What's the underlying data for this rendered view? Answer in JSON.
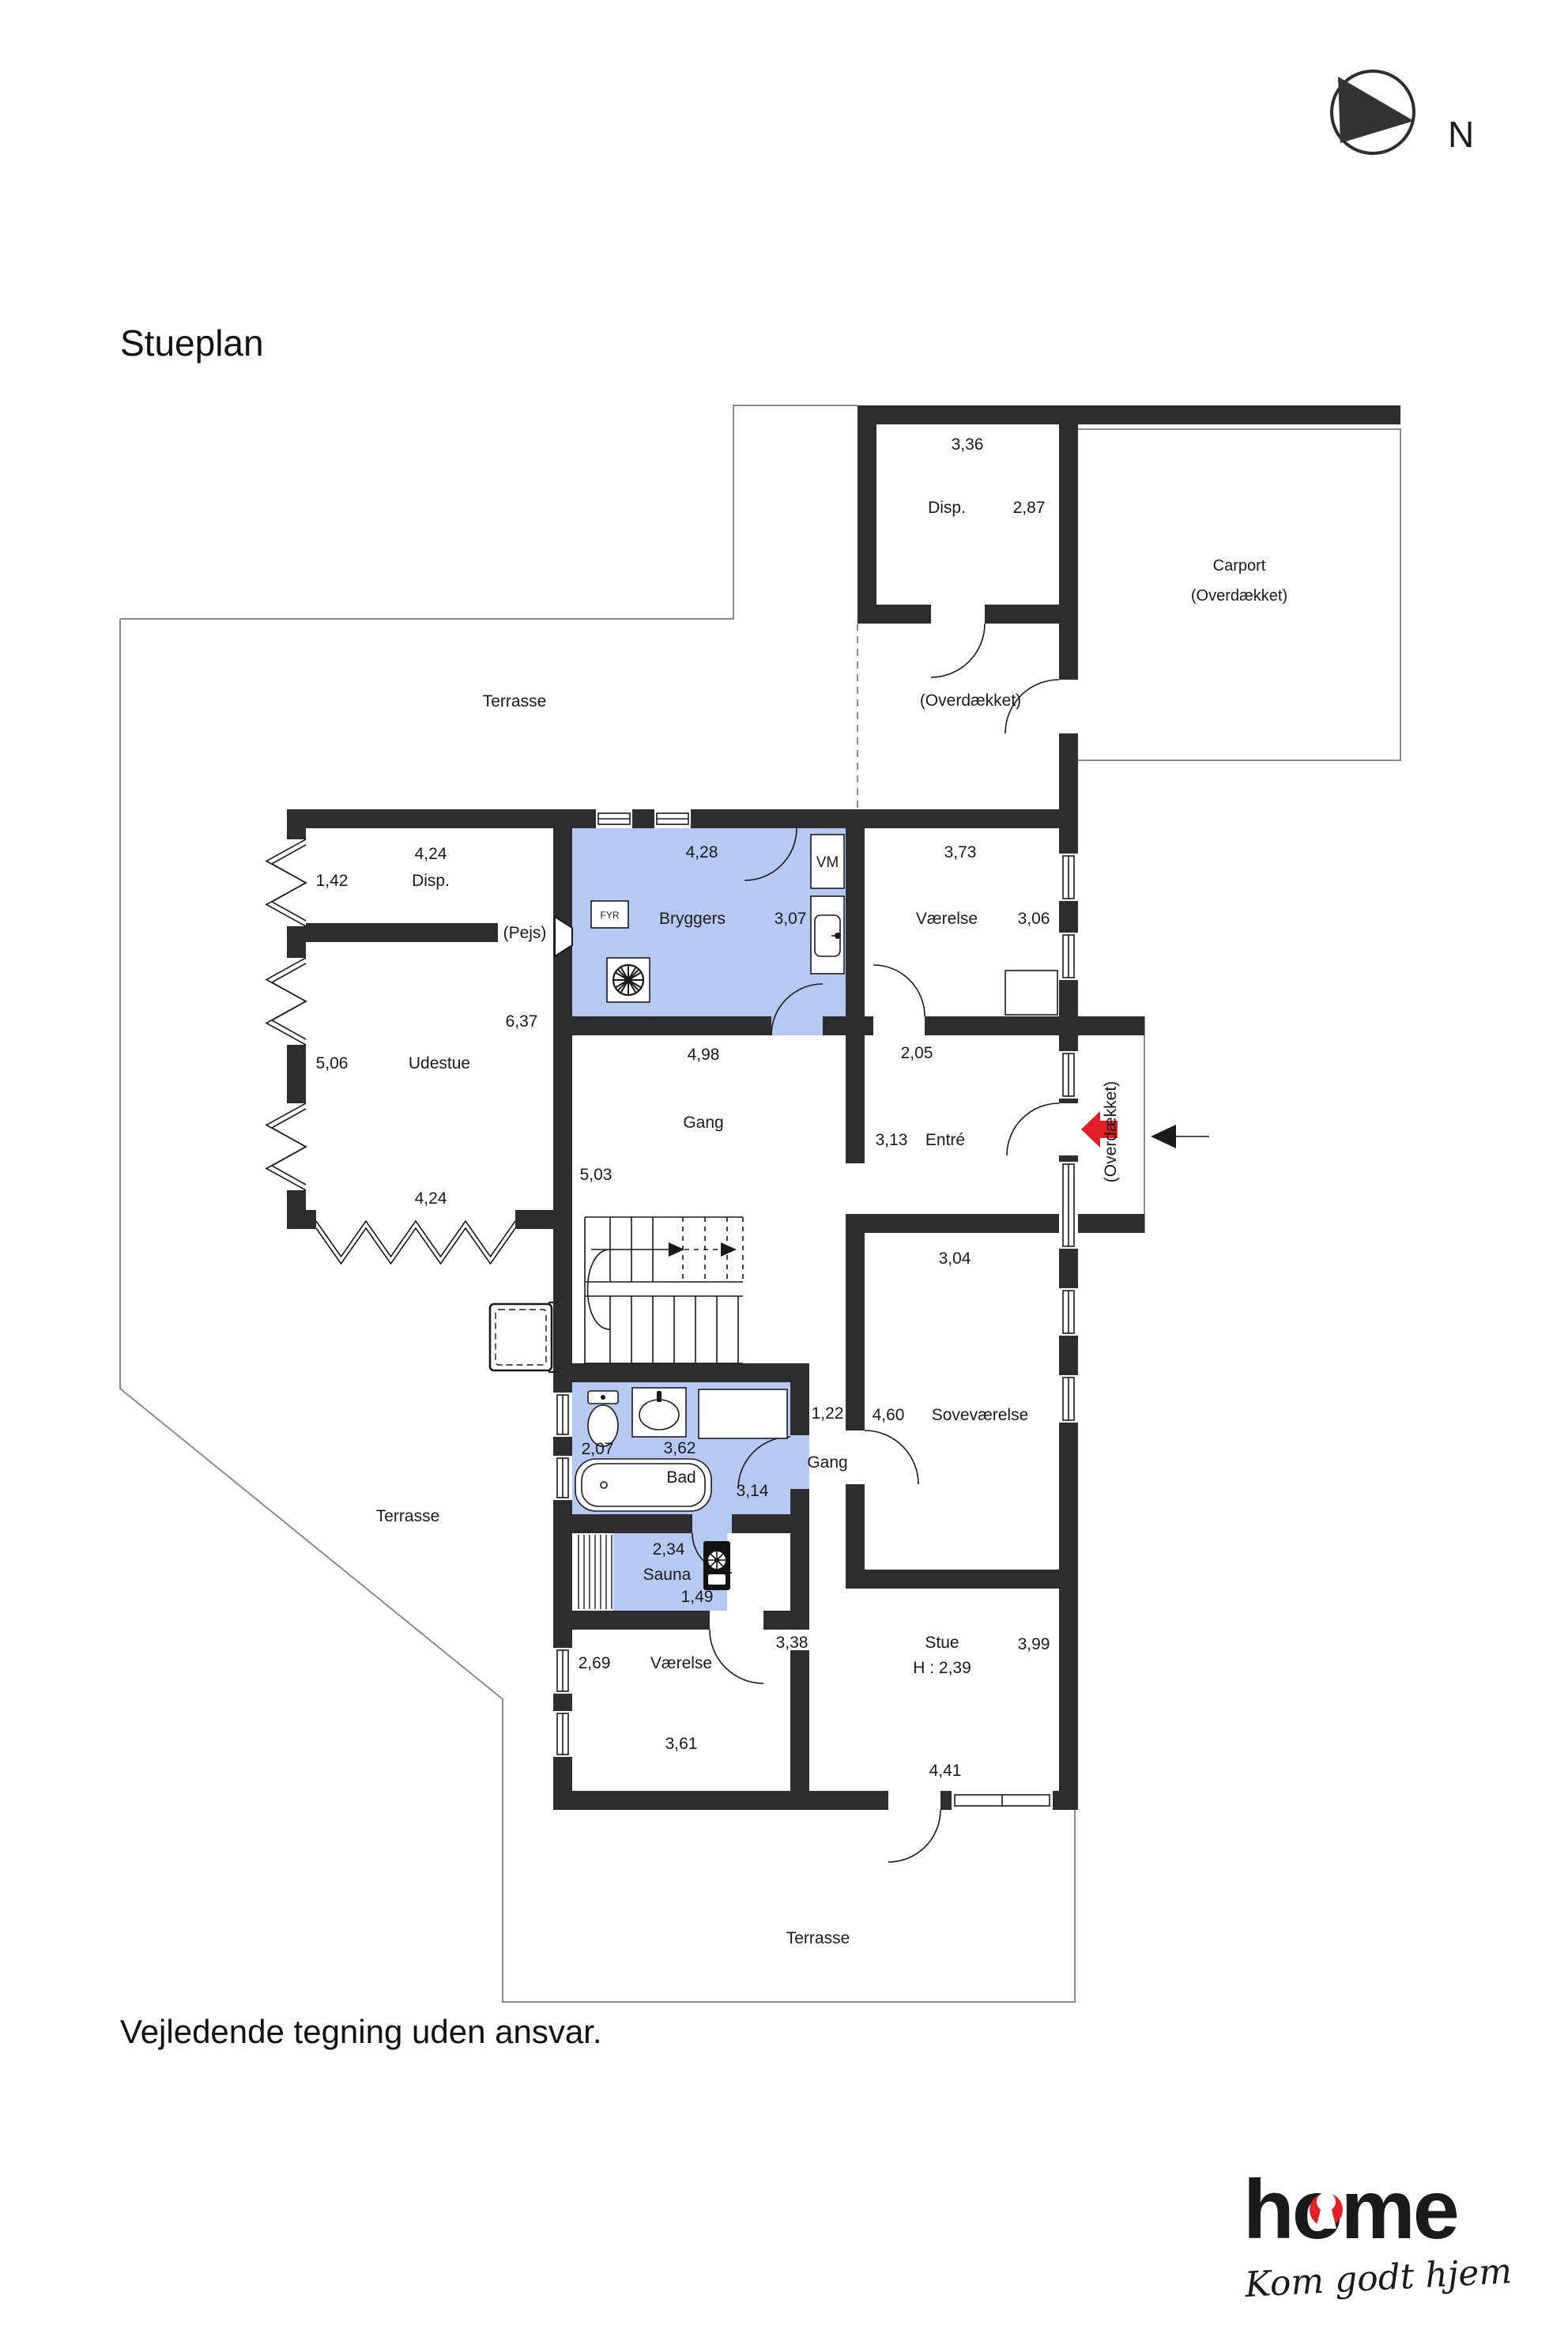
{
  "title": "Stueplan",
  "footer": "Vejledende tegning uden ansvar.",
  "compass": {
    "label": "N"
  },
  "logo": {
    "brand": "home",
    "tagline": "Kom godt hjem"
  },
  "colors": {
    "wall": "#2d2d2d",
    "room_blue": "#b6c9f3",
    "accent_red": "#e31e24",
    "outline_gray": "#8c8c8c"
  },
  "rooms": {
    "disp_top": {
      "name": "Disp.",
      "width": "3,36",
      "depth": "2,87"
    },
    "carport": {
      "name": "Carport",
      "note": "(Overdækket)"
    },
    "overdaekket_top": {
      "note": "(Overdækket)"
    },
    "terrasse_top": {
      "name": "Terrasse"
    },
    "terrasse_left": {
      "name": "Terrasse"
    },
    "terrasse_bottom": {
      "name": "Terrasse"
    },
    "bryggers": {
      "name": "Bryggers",
      "width": "4,28",
      "depth": "3,07"
    },
    "vaerelse_top": {
      "name": "Værelse",
      "width": "3,73",
      "depth": "3,06"
    },
    "disp_left": {
      "name": "Disp.",
      "width": "4,24",
      "depth": "1,42"
    },
    "pejs": {
      "note": "(Pejs)"
    },
    "udestue": {
      "name": "Udestue",
      "depth": "5,06",
      "east": "6,37",
      "width_bottom": "4,24"
    },
    "gang": {
      "name": "Gang",
      "width": "4,98",
      "depth": "5,03"
    },
    "hall": {
      "width": "2,05"
    },
    "entre": {
      "name": "Entré",
      "width": "3,13"
    },
    "porch": {
      "note": "(Overdækket)"
    },
    "sovevaerelse": {
      "name": "Soveværelse",
      "width": "3,04",
      "depth": "4,60"
    },
    "gang2": {
      "name": "Gang",
      "width": "1,22"
    },
    "bad": {
      "name": "Bad",
      "width": "3,62",
      "depth": "2,07",
      "east": "3,14"
    },
    "sauna": {
      "name": "Sauna",
      "width": "2,34",
      "door": "1,49"
    },
    "vaerelse_bottom": {
      "name": "Værelse",
      "depth": "2,69",
      "width": "3,61"
    },
    "stue": {
      "name": "Stue",
      "ceiling": "H : 2,39",
      "east": "3,99",
      "width": "4,41",
      "door": "3,38"
    }
  },
  "fixtures": {
    "washing_machine": "VM",
    "furnace": "FYR"
  }
}
